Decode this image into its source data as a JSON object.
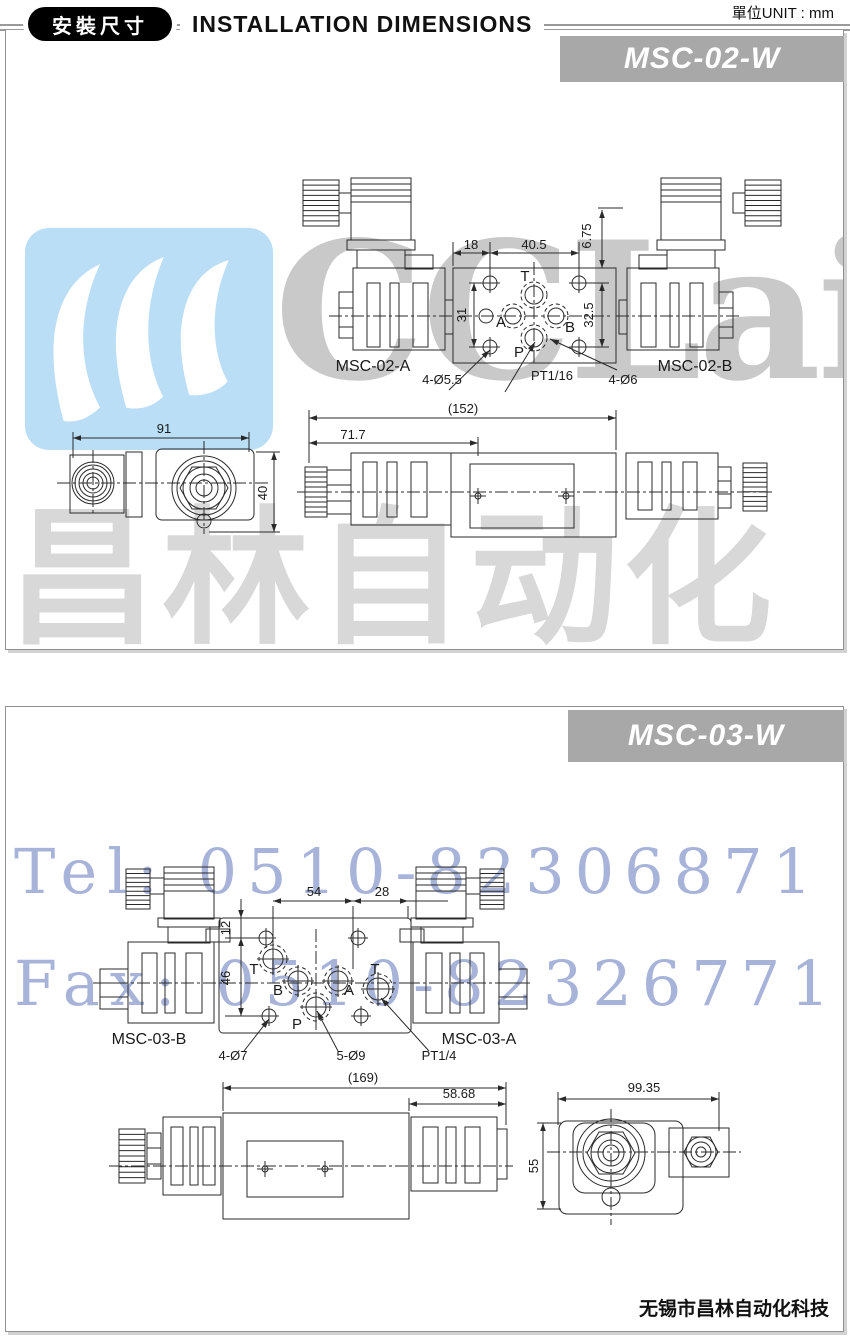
{
  "header": {
    "badge": "安裝尺寸",
    "title": "INSTALLATION DIMENSIONS",
    "unit": "單位UNIT : mm"
  },
  "watermark": {
    "logo_text": "CCLair",
    "logo_cn": "昌林自动化",
    "tel": "Tel: 0510-82306871",
    "fax": "Fax: 0510-82326771"
  },
  "colors": {
    "banner_bg": "#a8a8a8",
    "banner_text": "#ffffff",
    "watermark_blue": "#a7b3d9",
    "logo_blue": "#badef5",
    "logo_gray": "#c9c9c9",
    "cn_gray": "#d8d8d8",
    "line": "#2a2a2a"
  },
  "panel1": {
    "model": "MSC-02-W",
    "top_view": {
      "label_left": "MSC-02-A",
      "label_right": "MSC-02-B",
      "ports": [
        "T",
        "A",
        "B",
        "P"
      ],
      "dim_18": "18",
      "dim_40_5": "40.5",
      "dim_6_75": "6.75",
      "dim_31": "31",
      "dim_32_5": "32.5",
      "hole_small": "4-Ø5.5",
      "thread": "PT1/16",
      "hole_big": "4-Ø6"
    },
    "side_view": {
      "dim_total": "(152)",
      "dim_717": "71.7"
    },
    "end_view": {
      "dim_91": "91",
      "dim_40": "40"
    }
  },
  "panel2": {
    "model": "MSC-03-W",
    "top_view": {
      "label_left": "MSC-03-B",
      "label_right": "MSC-03-A",
      "ports": [
        "T",
        "B",
        "A",
        "T",
        "P"
      ],
      "dim_54": "54",
      "dim_28": "28",
      "dim_12": "12",
      "dim_46": "46",
      "hole_small": "4-Ø7",
      "hole_big": "5-Ø9",
      "thread": "PT1/4"
    },
    "side_view": {
      "dim_total": "(169)",
      "dim_5868": "58.68"
    },
    "end_view": {
      "dim_9935": "99.35",
      "dim_55": "55"
    }
  },
  "footer": {
    "company": "无锡市昌林自动化科技"
  }
}
